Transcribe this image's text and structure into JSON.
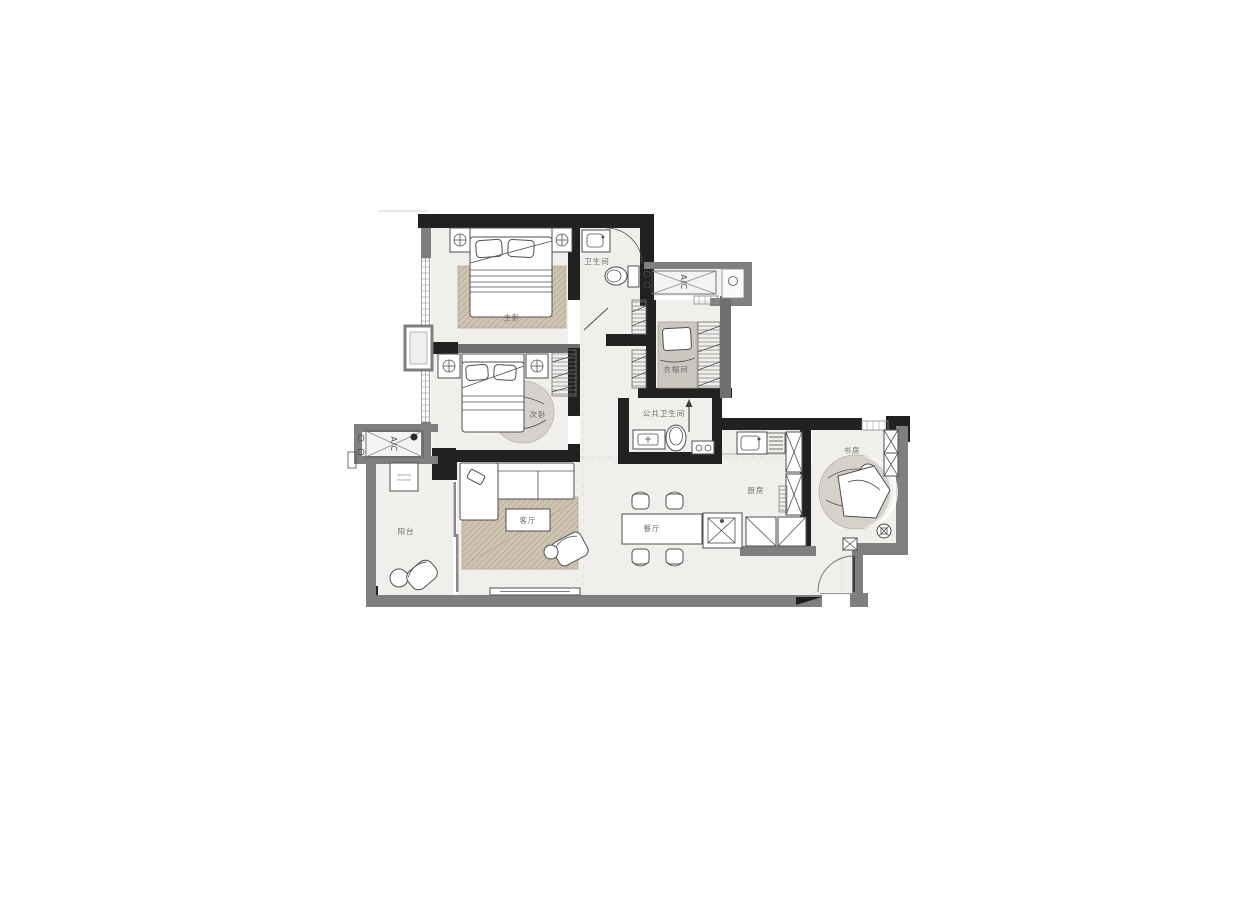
{
  "plan": {
    "title": "apartment-floor-plan",
    "rooms": [
      {
        "id": "master-bedroom",
        "label": "主卧"
      },
      {
        "id": "ensuite-bathroom",
        "label": "卫生间"
      },
      {
        "id": "cloakroom",
        "label": "衣帽间"
      },
      {
        "id": "second-bedroom",
        "label": "次卧"
      },
      {
        "id": "public-bathroom",
        "label": "公共卫生间"
      },
      {
        "id": "balcony",
        "label": "阳台"
      },
      {
        "id": "living-room",
        "label": "客厅"
      },
      {
        "id": "dining-room",
        "label": "餐厅"
      },
      {
        "id": "kitchen",
        "label": "厨房"
      },
      {
        "id": "study",
        "label": "书房"
      }
    ],
    "annotations": {
      "ac_left": "A/C",
      "ac_top": "A/C",
      "washer_line1": "Washing",
      "washer_line2": "machine"
    },
    "colors": {
      "background": "#ffffff",
      "floor": "#f0efec",
      "wall_dark": "#212121",
      "wall_gray": "#7f7f7f",
      "rug_wood": "#cfc4b2",
      "rug_round": "#d6d2cb",
      "daybed": "#cbc6bf",
      "label_text": "#6e6e6e"
    }
  }
}
